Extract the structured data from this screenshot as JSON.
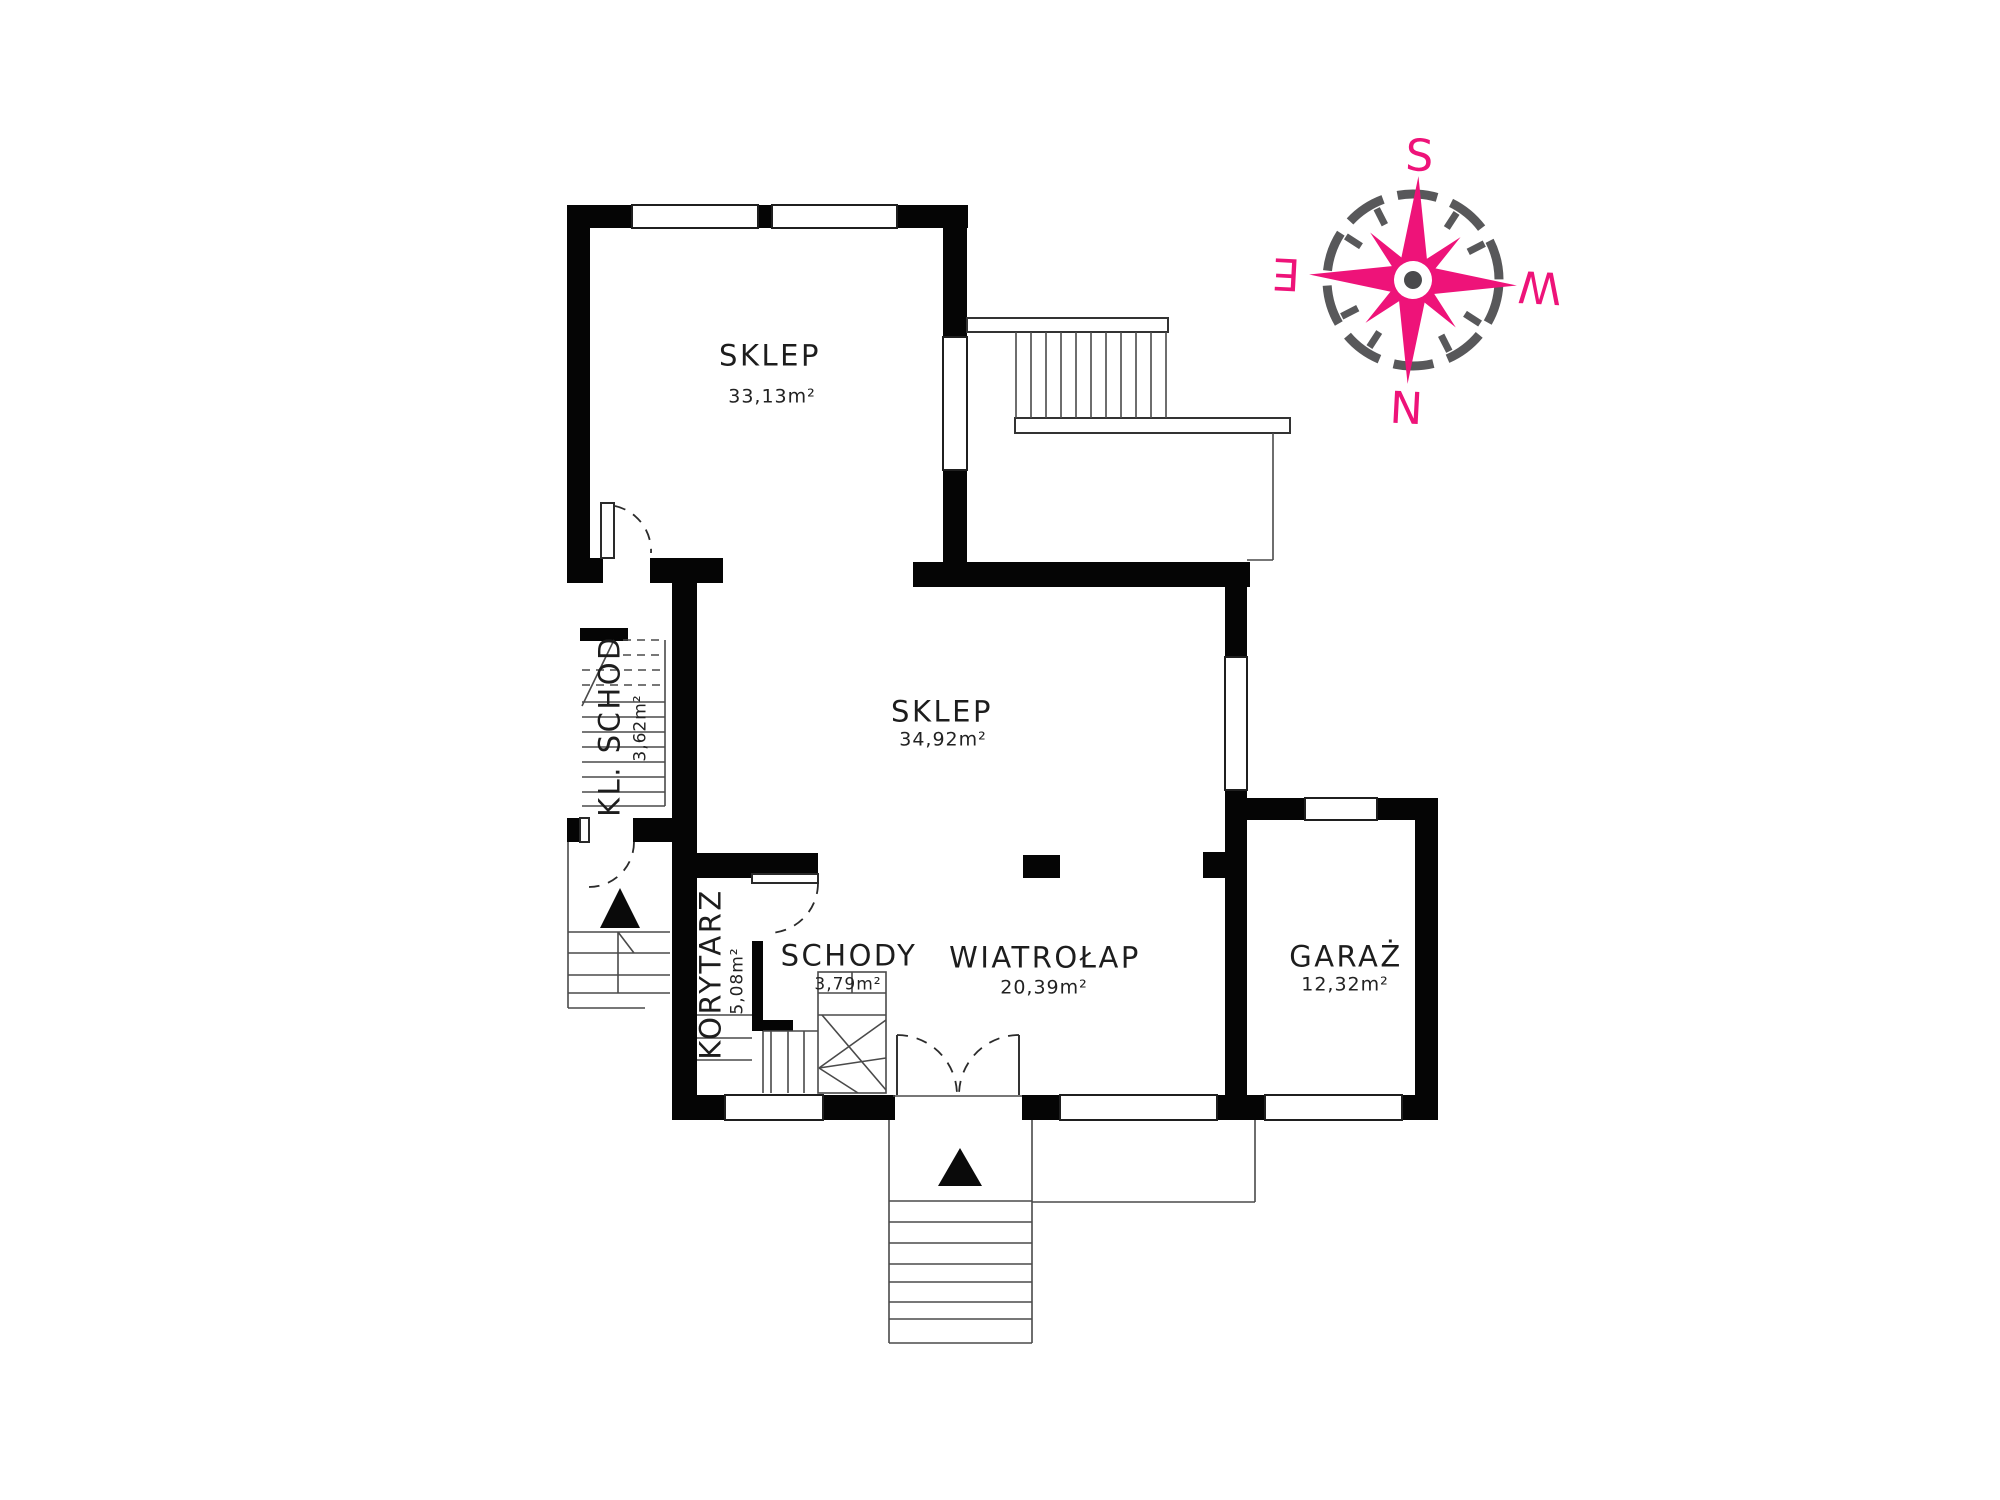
{
  "document": {
    "type": "floor-plan",
    "language": "Polish"
  },
  "rooms": {
    "shop_upper": {
      "name": "SKLEP",
      "area": "33,13m²"
    },
    "shop_main": {
      "name": "SKLEP",
      "area": "34,92m²"
    },
    "staircase": {
      "name": "KL. SCHOD",
      "area": "3,62m²"
    },
    "corridor": {
      "name": "KORYTARZ",
      "area": "5,08m²"
    },
    "stairs": {
      "name": "SCHODY",
      "area": "3,79m²"
    },
    "vestibule": {
      "name": "WIATROŁAP",
      "area": "20,39m²"
    },
    "garage": {
      "name": "GARAŻ",
      "area": "12,32m²"
    }
  },
  "compass": {
    "south": "S",
    "west": "W",
    "north": "N",
    "east": "E"
  },
  "colors": {
    "wall": "#050505",
    "compass_pink": "#EE1379",
    "compass_gray": "#58585A",
    "line": "#4A4A4A"
  }
}
